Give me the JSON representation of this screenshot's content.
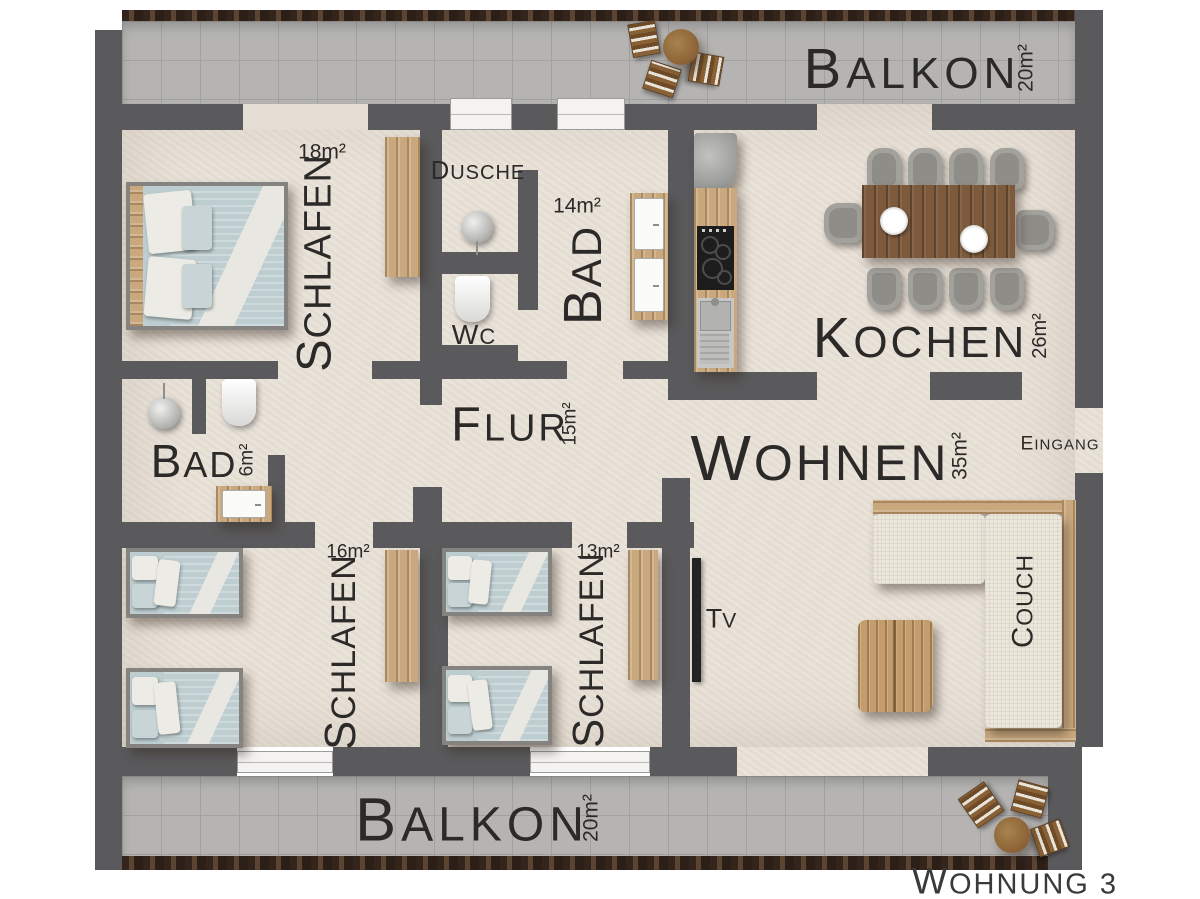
{
  "title": "Wohnung 3 floor plan",
  "rooms": [
    {
      "id": "balkon-top",
      "name": "BALKON",
      "area": "20m²"
    },
    {
      "id": "schlafen-18",
      "name": "SCHLAFEN",
      "area": "18m²"
    },
    {
      "id": "dusche",
      "name": "DUSCHE",
      "area": ""
    },
    {
      "id": "wc",
      "name": "WC",
      "area": ""
    },
    {
      "id": "bad-14",
      "name": "BAD",
      "area": "14m²"
    },
    {
      "id": "kochen",
      "name": "KOCHEN",
      "area": "26m²"
    },
    {
      "id": "bad-6",
      "name": "BAD",
      "area": "6m²"
    },
    {
      "id": "flur",
      "name": "FLUR",
      "area": "15m²"
    },
    {
      "id": "wohnen",
      "name": "WOHNEN",
      "area": "35m²"
    },
    {
      "id": "eingang",
      "name": "EINGANG"
    },
    {
      "id": "schlafen-16",
      "name": "SCHLAFEN",
      "area": "16m²"
    },
    {
      "id": "schlafen-13",
      "name": "SCHLAFEN",
      "area": "13m²"
    },
    {
      "id": "balkon-bottom",
      "name": "BALKON",
      "area": "20m²"
    },
    {
      "id": "couch",
      "name": "COUCH"
    },
    {
      "id": "tv",
      "name": "TV"
    }
  ],
  "footer": {
    "label": "WOHNUNG 3"
  },
  "colors": {
    "wall": "#5a5a5c",
    "floor": "#e9e2d8",
    "balcony_tile": "#b5b4b2",
    "railing": "#46332a",
    "bed_linen": "#bdcdd0",
    "pillow": "#edebe5",
    "wood": "#c9a87e",
    "dining_table": "#7d5a3c",
    "couch_fabric": "#ece7db",
    "text": "#2b2a28"
  },
  "furniture": [
    "double-bed",
    "single-bed x4",
    "wardrobe x3",
    "shower x2",
    "toilet x2",
    "washbasin x3",
    "kitchen-counter",
    "cooktop",
    "kitchen-sink",
    "fridge",
    "dining-table",
    "dining-chair x10",
    "l-couch",
    "coffee-table",
    "tv",
    "balcony-table x2",
    "balcony-chair x6"
  ]
}
